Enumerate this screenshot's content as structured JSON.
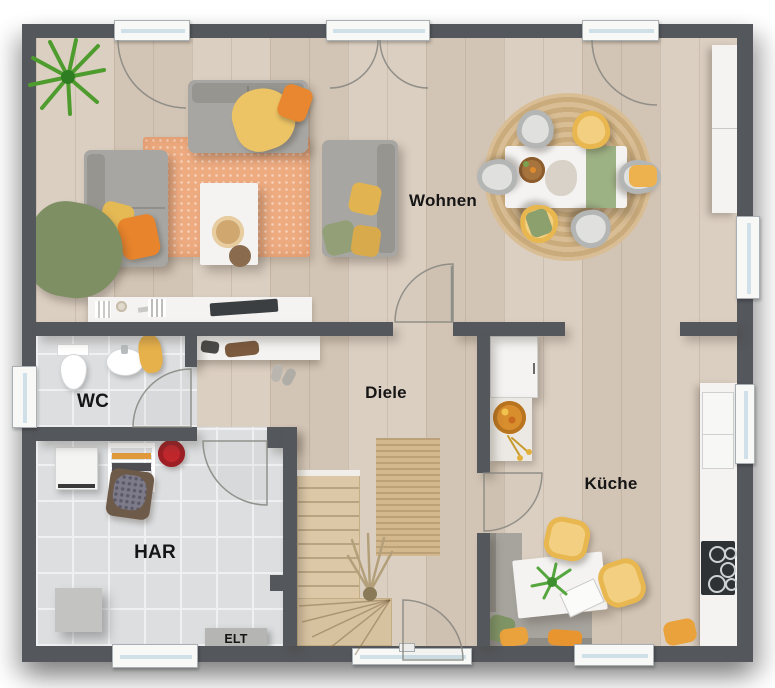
{
  "rooms": {
    "wohnen": "Wohnen",
    "diele": "Diele",
    "wc": "WC",
    "har": "HAR",
    "kueche": "Küche",
    "elt": "ELT"
  },
  "colors": {
    "wall": "#54575c",
    "floor_wood": "#d7cabb",
    "floor_tile": "#dcdee0",
    "living_rug": "#eeab80",
    "jute_rug": "#d4b88e",
    "sofa_gray": "#a7a6a2",
    "accent_orange": "#e8872f",
    "accent_yellow": "#e9b74f",
    "accent_green": "#84956a",
    "furniture_white": "#f4f3f1",
    "stairs_wood": "#dcc8a7",
    "cooktop_black": "#2f3235",
    "bucket_red": "#c0272d"
  }
}
